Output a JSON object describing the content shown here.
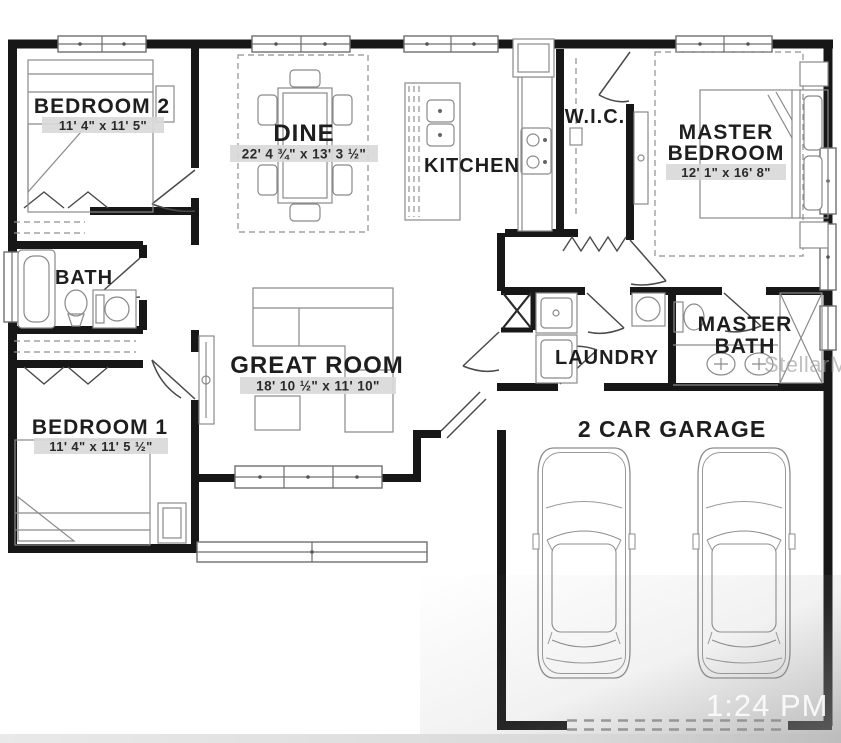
{
  "rooms": {
    "bedroom2": {
      "name": "BEDROOM 2",
      "dims": "11' 4\" x 11' 5\""
    },
    "dine": {
      "name": "DINE",
      "dims": "22' 4 ¾\" x 13' 3 ½\""
    },
    "kitchen": {
      "name": "KITCHEN"
    },
    "wic": {
      "name": "W.I.C."
    },
    "master_bedroom": {
      "line1": "MASTER",
      "line2": "BEDROOM",
      "dims": "12' 1\" x 16' 8\""
    },
    "bath": {
      "name": "BATH"
    },
    "great_room": {
      "name": "GREAT ROOM",
      "dims": "18' 10 ½\" x 11' 10\""
    },
    "laundry": {
      "name": "LAUNDRY"
    },
    "master_bath": {
      "line1": "MASTER",
      "line2": "BATH"
    },
    "bedroom1": {
      "name": "BEDROOM 1",
      "dims": "11' 4\" x 11' 5 ½\""
    },
    "garage": {
      "name": "2 CAR GARAGE"
    }
  },
  "overlay": {
    "watermark": "StellarMLS",
    "clock": "1:24 PM"
  },
  "colors": {
    "wall": "#171717",
    "dim_highlight": "#d9d9d9",
    "watermark_gray": "#9b9b9b"
  }
}
